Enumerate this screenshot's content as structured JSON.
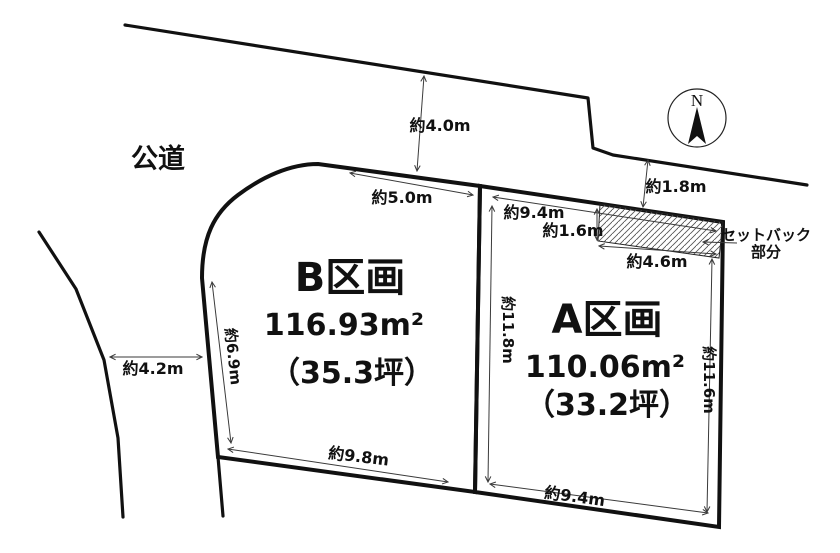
{
  "colors": {
    "line": "#111111",
    "arrow": "#3a3a3a",
    "background": "#ffffff",
    "hatch": "#555555"
  },
  "road": {
    "label": "公道"
  },
  "compass": {
    "north": "N"
  },
  "plots": {
    "b": {
      "name": "B区画",
      "area": "116.93m²",
      "tsubo": "（35.3坪）"
    },
    "a": {
      "name": "A区画",
      "area": "110.06m²",
      "tsubo": "（33.2坪）"
    }
  },
  "setback": {
    "line1": "セットバック",
    "line2": "部分"
  },
  "measurements": {
    "road_top": "約4.0m",
    "b_top": "約5.0m",
    "road_right": "約1.8m",
    "a_top": "約9.4m",
    "setback_depth": "約1.6m",
    "setback_width": "約4.6m",
    "road_left": "約4.2m",
    "b_left": "約6.9m",
    "a_left": "約11.8m",
    "a_right": "約11.6m",
    "b_bottom": "約9.8m",
    "a_bottom": "約9.4m"
  }
}
